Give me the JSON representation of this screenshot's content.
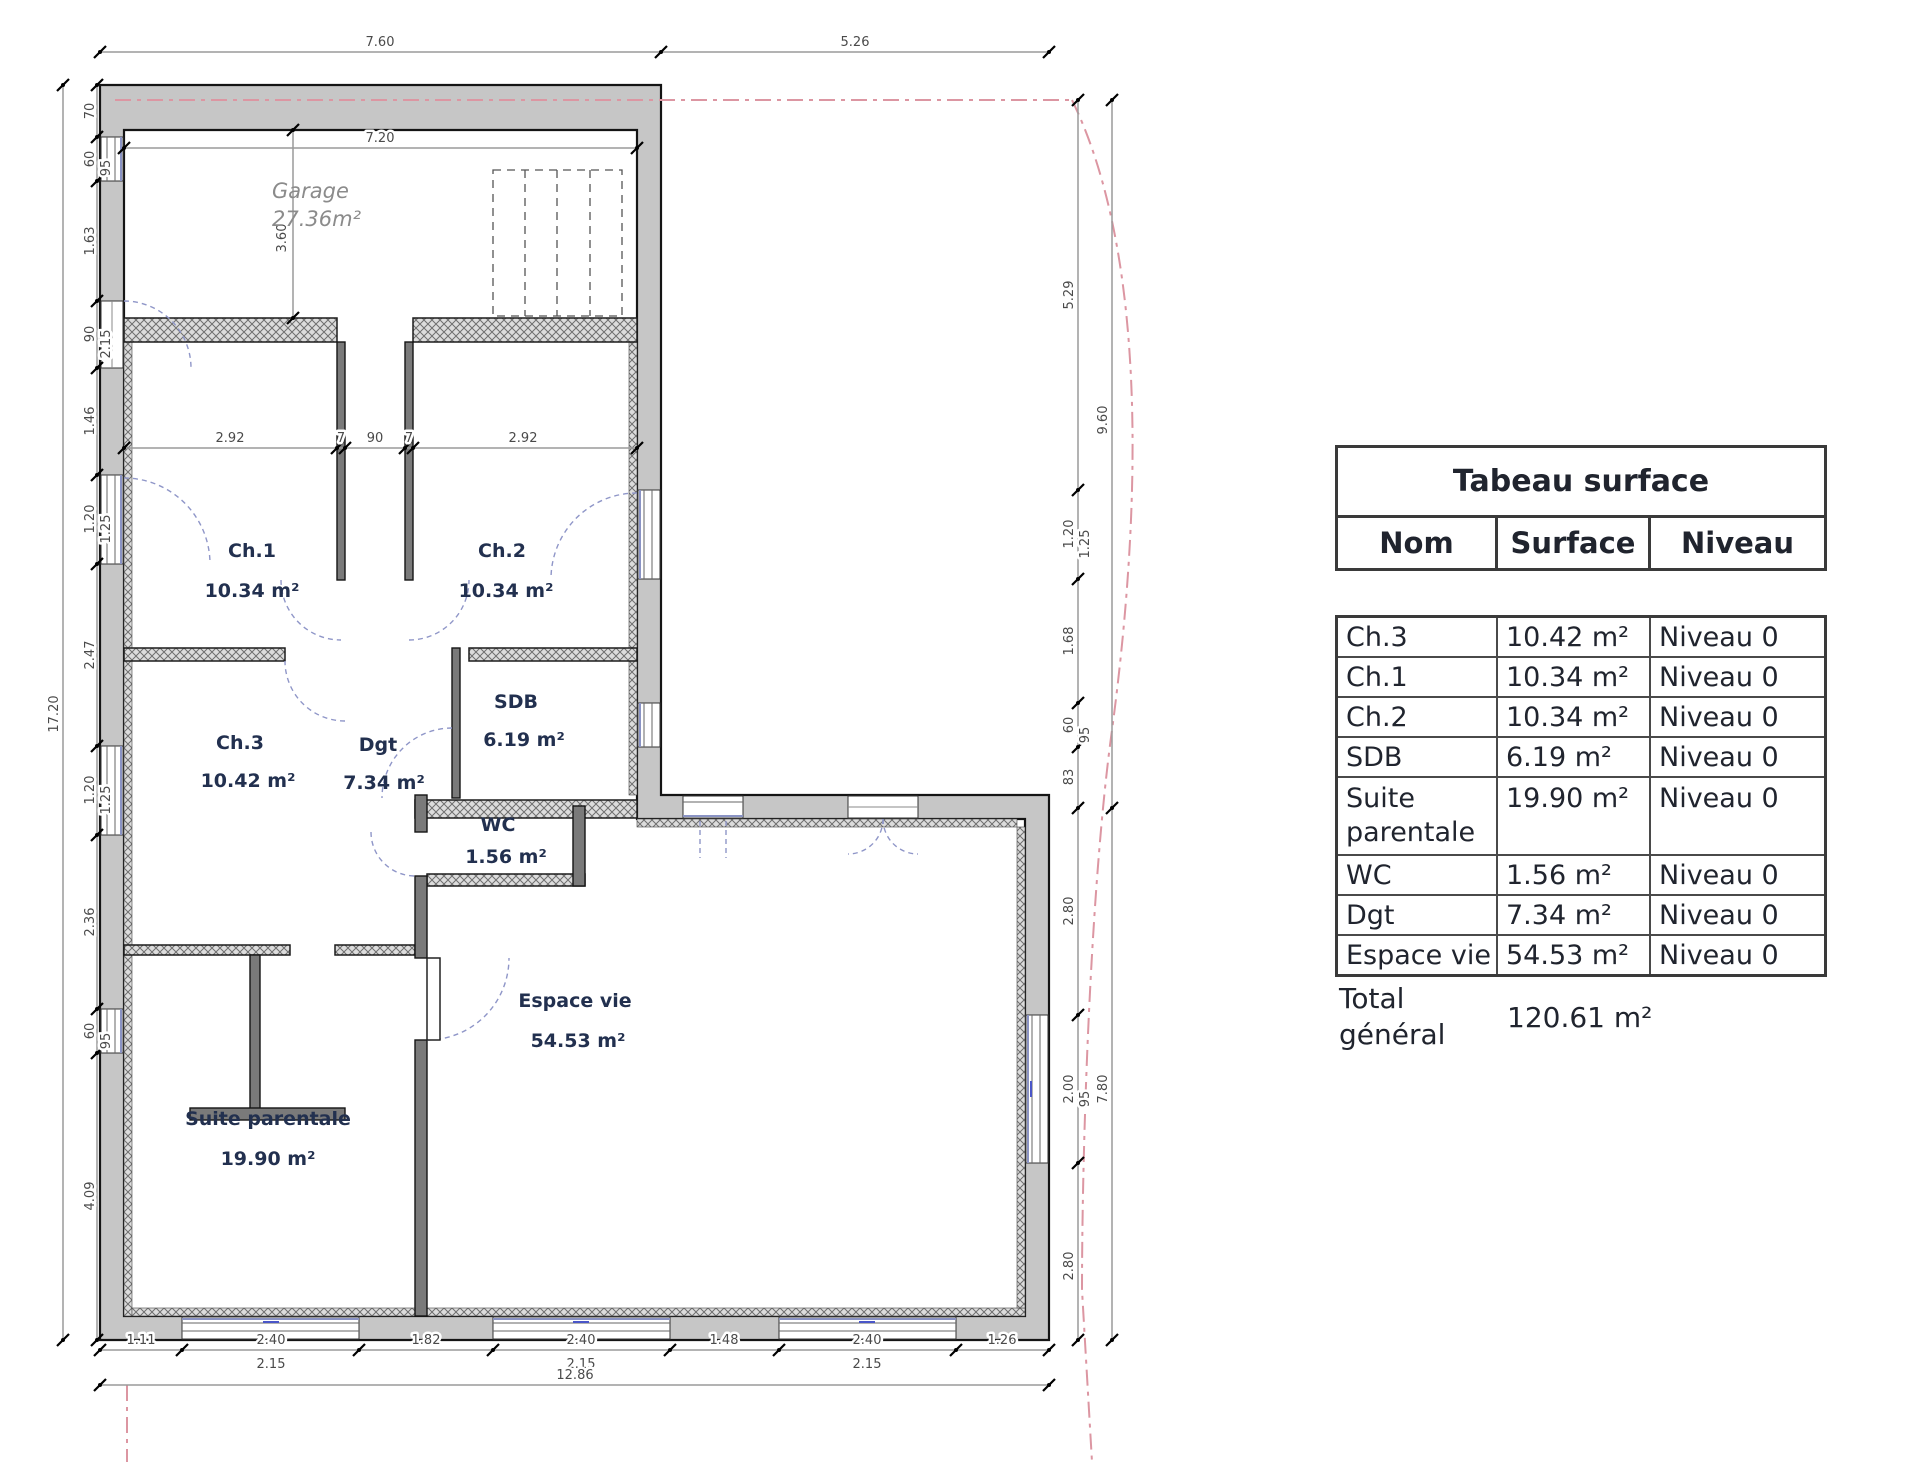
{
  "plan": {
    "rooms": [
      {
        "name": "Garage",
        "area": "27.36m²"
      },
      {
        "name": "Ch.1",
        "area": "10.34 m²"
      },
      {
        "name": "Ch.2",
        "area": "10.34 m²"
      },
      {
        "name": "Ch.3",
        "area": "10.42 m²"
      },
      {
        "name": "Dgt",
        "area": "7.34 m²"
      },
      {
        "name": "SDB",
        "area": "6.19 m²"
      },
      {
        "name": "WC",
        "area": "1.56 m²"
      },
      {
        "name": "Suite parentale",
        "area": "19.90 m²"
      },
      {
        "name": "Espace vie",
        "area": "54.53 m²"
      }
    ],
    "dimensions": {
      "top": [
        "7.60",
        "5.26"
      ],
      "garage": [
        "7.20",
        "3.60"
      ],
      "bedroom_row": [
        "2.92",
        "7",
        "90",
        "7",
        "2.92"
      ],
      "left_outer": "17.20",
      "left_chain": [
        "70",
        "60",
        "95",
        "1.63",
        "90",
        "2.15",
        "1.46",
        "1.20",
        "1.25",
        "2.47",
        "1.20",
        "1.25",
        "2.36",
        "60",
        "95",
        "4.09"
      ],
      "right_chain": [
        "5.29",
        "1.20",
        "1.25",
        "1.68",
        "60",
        "95",
        "83",
        "2.80",
        "2.00",
        "95",
        "2.80"
      ],
      "right_outer": [
        "9.60",
        "7.80"
      ],
      "bottom_row1": [
        "1.11",
        "2.40",
        "1.82",
        "2.40",
        "1.48",
        "2.40",
        "1.26"
      ],
      "bottom_row2": [
        "2.15",
        "2.15",
        "2.15"
      ],
      "bottom_total": "12.86"
    }
  },
  "table": {
    "title": "Tabeau surface",
    "columns": [
      "Nom",
      "Surface",
      "Niveau"
    ],
    "rows": [
      {
        "nom": "Ch.3",
        "surface": "10.42 m²",
        "niveau": "Niveau 0"
      },
      {
        "nom": "Ch.1",
        "surface": "10.34 m²",
        "niveau": "Niveau 0"
      },
      {
        "nom": "Ch.2",
        "surface": "10.34 m²",
        "niveau": "Niveau 0"
      },
      {
        "nom": "SDB",
        "surface": "6.19 m²",
        "niveau": "Niveau 0"
      },
      {
        "nom": "Suite parentale",
        "surface": "19.90 m²",
        "niveau": "Niveau 0"
      },
      {
        "nom": "WC",
        "surface": "1.56 m²",
        "niveau": "Niveau 0"
      },
      {
        "nom": "Dgt",
        "surface": "7.34 m²",
        "niveau": "Niveau 0"
      },
      {
        "nom": "Espace vie",
        "surface": "54.53 m²",
        "niveau": "Niveau 0"
      }
    ],
    "total": {
      "label": "Total général",
      "value": "120.61 m²"
    }
  },
  "colors": {
    "wall": "#c6c6c6",
    "room_label": "#22304f",
    "garage_label": "#8b8b8b",
    "dimension_text": "#4a4a4a",
    "property_line": "#dc96a2",
    "window_glass": "#8a93c4",
    "table_text": "#20242e"
  }
}
